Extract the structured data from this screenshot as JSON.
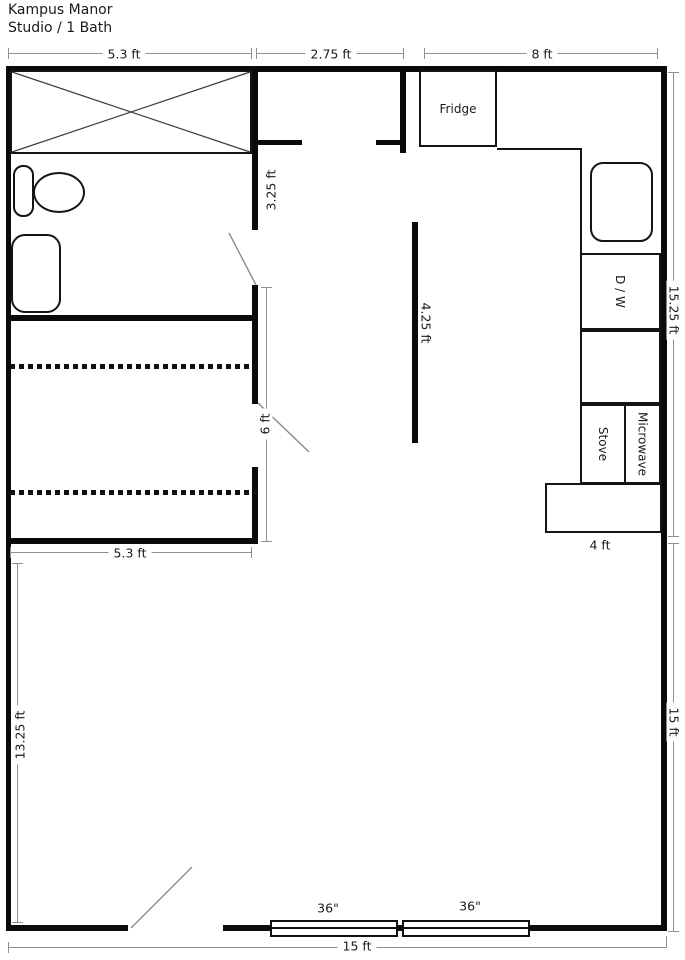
{
  "title": "Kampus Manor",
  "subtitle": "Studio / 1 Bath",
  "dims": {
    "bath_width": "5.3 ft",
    "hall_width": "2.75 ft",
    "kitchen_width": "8 ft",
    "bath_wall": "3.25 ft",
    "right_upper": "15.25 ft",
    "island_wall": "4.25 ft",
    "closet_opening": "6 ft",
    "closet_width": "5.3 ft",
    "living_height": "13.25 ft",
    "counter_width": "4 ft",
    "right_lower": "15 ft",
    "bottom_width": "15 ft",
    "window_left": "36\"",
    "window_right": "36\""
  },
  "appliances": {
    "fridge": "Fridge",
    "dishwasher": "D / W",
    "stove": "Stove",
    "microwave": "Microwave"
  },
  "colors": {
    "wall": "#0b0b0b",
    "fixture_line": "#141414",
    "dimension_line": "#8f8f8f",
    "text": "#1b1b1b",
    "background": "#ffffff"
  }
}
